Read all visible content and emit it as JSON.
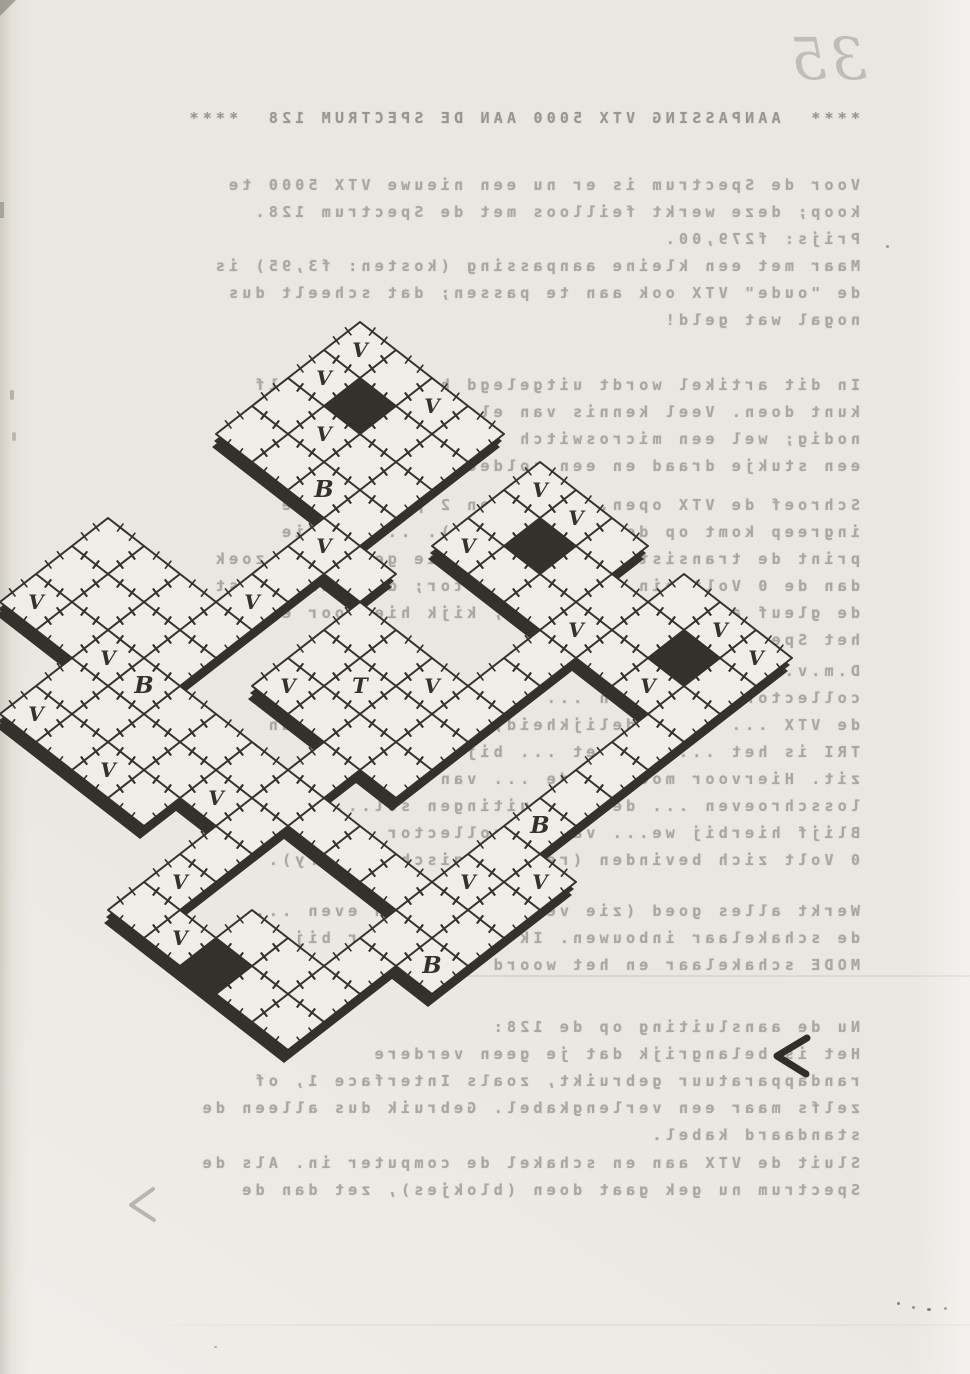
{
  "page": {
    "number": "35"
  },
  "content": {
    "title": "****  AANPASSING VTX 5000 AAN DE SPECTRUM 128  ****",
    "p1": "Voor de Spectrum is er nu een nieuwe VTX 5000 te\nkoop; deze werkt feilloos met de Spectrum 128.\nPrijs: f279,00.",
    "p2": "Maar met een kleine aanpassing (kosten: f3,95) is\nde \"oude\" VTX ook aan te passen; dat scheelt dus\nnogal wat geld!",
    "p3": "In dit artikel wordt uitgelegd hoe je dit zelf\nkunt doen. Veel kennis van elektronica is niet\nnodig; wel een microswitch (zie: f3,95),\neen stukje draad en een soldeerbout.",
    "p4": "Schroef de VTX open. De ... en 2 p...ten. De\ningreep komt op de print (...ts). ... op die\nprint de transistor TRI ... in die gevonden, zoek\ndan de 0 Volt pin op de connector; deze zit naast\nde gleuf aan de rechterkant; kijk hiervoor evt. in\nhet Spectrum handboek.",
    "p5": "D.m.v. ... de a...\ncollector van TRI en ... (0 Volt op de ...\nde VTX ... de duidelijkheid; de collector van\nTRI is het ... dat het ... bij ... RS\nzit. Hiervoor moet je de ... van de print ...\nlosschroeven ... de aansluitingen sol...\nBlijf hierbij we... van de collector ... de\n0 Volt zich bevinden (regel logisch - Perry).",
    "p6": "Werkt alles goed (zie verderop) , dan even ...\nde schakelaar inbouwen. Ik heb hiervoor bij ...\nMODE schakelaar en het woord ...",
    "p7": "Nu de aansluiting op de 128:\nHet is belangrijk dat je geen verdere\nrandapparatuur gebruikt, zoals Interface 1, of\nzelfs maar een verlengkabel. Gebruik dus alleen de\nstandaard kabel.",
    "p8": "Sluit de VTX aan en schakel de computer in. Als de\nSpectrum nu gek gaat doen (blokjes), zet dan de"
  },
  "marks": {
    "arrow_dark": "<",
    "arrow_faint": "<"
  },
  "maze": {
    "ink": "#32312c",
    "cell": "#efede8",
    "origin": [
      360,
      350
    ],
    "step": [
      36,
      28
    ],
    "rects": [
      {
        "i": 0,
        "j": 0,
        "w": 4,
        "h": 4
      },
      {
        "i": 3,
        "j": 4,
        "w": 1,
        "h": 7
      },
      {
        "i": 5,
        "j": 0,
        "w": 3,
        "h": 3
      },
      {
        "i": 8,
        "j": 1,
        "w": 1,
        "h": 2
      },
      {
        "i": 8,
        "j": 3,
        "w": 1,
        "h": 5
      },
      {
        "i": 9,
        "j": 0,
        "w": 3,
        "h": 3
      },
      {
        "i": 11,
        "j": 3,
        "w": 1,
        "h": 4
      },
      {
        "i": 11,
        "j": 7,
        "w": 2,
        "h": 2
      },
      {
        "i": 12,
        "j": 9,
        "w": 1,
        "h": 2
      },
      {
        "i": 7,
        "j": 9,
        "w": 5,
        "h": 1
      },
      {
        "i": 7,
        "j": 13,
        "w": 5,
        "h": 1
      },
      {
        "i": 7,
        "j": 10,
        "w": 1,
        "h": 3
      },
      {
        "i": 11,
        "j": 10,
        "w": 1,
        "h": 3
      },
      {
        "i": 9,
        "j": 12,
        "w": 2,
        "h": 1
      },
      {
        "i": 0,
        "j": 7,
        "w": 4,
        "h": 3
      },
      {
        "i": 2,
        "j": 10,
        "w": 2,
        "h": 2
      },
      {
        "i": 4,
        "j": 9,
        "w": 3,
        "h": 2
      },
      {
        "i": 4,
        "j": 11,
        "w": 2,
        "h": 1
      },
      {
        "i": 5,
        "j": 5,
        "w": 3,
        "h": 3
      },
      {
        "i": 7,
        "j": 8,
        "w": 1,
        "h": 1
      },
      {
        "i": 4,
        "j": 4,
        "w": 1,
        "h": 1
      }
    ],
    "dark_cells": [
      [
        1,
        1
      ],
      [
        6,
        1
      ],
      [
        10,
        1
      ],
      [
        9,
        13
      ]
    ],
    "letters": {
      "v": "V",
      "b": "B",
      "t": "T"
    },
    "v_cells": [
      [
        0,
        0
      ],
      [
        0,
        1
      ],
      [
        1,
        2
      ],
      [
        2,
        0
      ],
      [
        3,
        4
      ],
      [
        5,
        0
      ],
      [
        5,
        2
      ],
      [
        6,
        0
      ],
      [
        8,
        2
      ],
      [
        10,
        0
      ],
      [
        11,
        0
      ],
      [
        10,
        2
      ],
      [
        5,
        7
      ],
      [
        7,
        5
      ],
      [
        3,
        6
      ],
      [
        0,
        9
      ],
      [
        2,
        9
      ],
      [
        2,
        11
      ],
      [
        4,
        11
      ],
      [
        6,
        10
      ],
      [
        7,
        12
      ],
      [
        8,
        13
      ],
      [
        11,
        8
      ],
      [
        12,
        7
      ]
    ],
    "b_cells": [
      [
        2,
        3
      ],
      [
        3,
        9
      ],
      [
        11,
        6
      ],
      [
        12,
        10
      ]
    ],
    "t_cells": [
      [
        6,
        6
      ]
    ]
  }
}
